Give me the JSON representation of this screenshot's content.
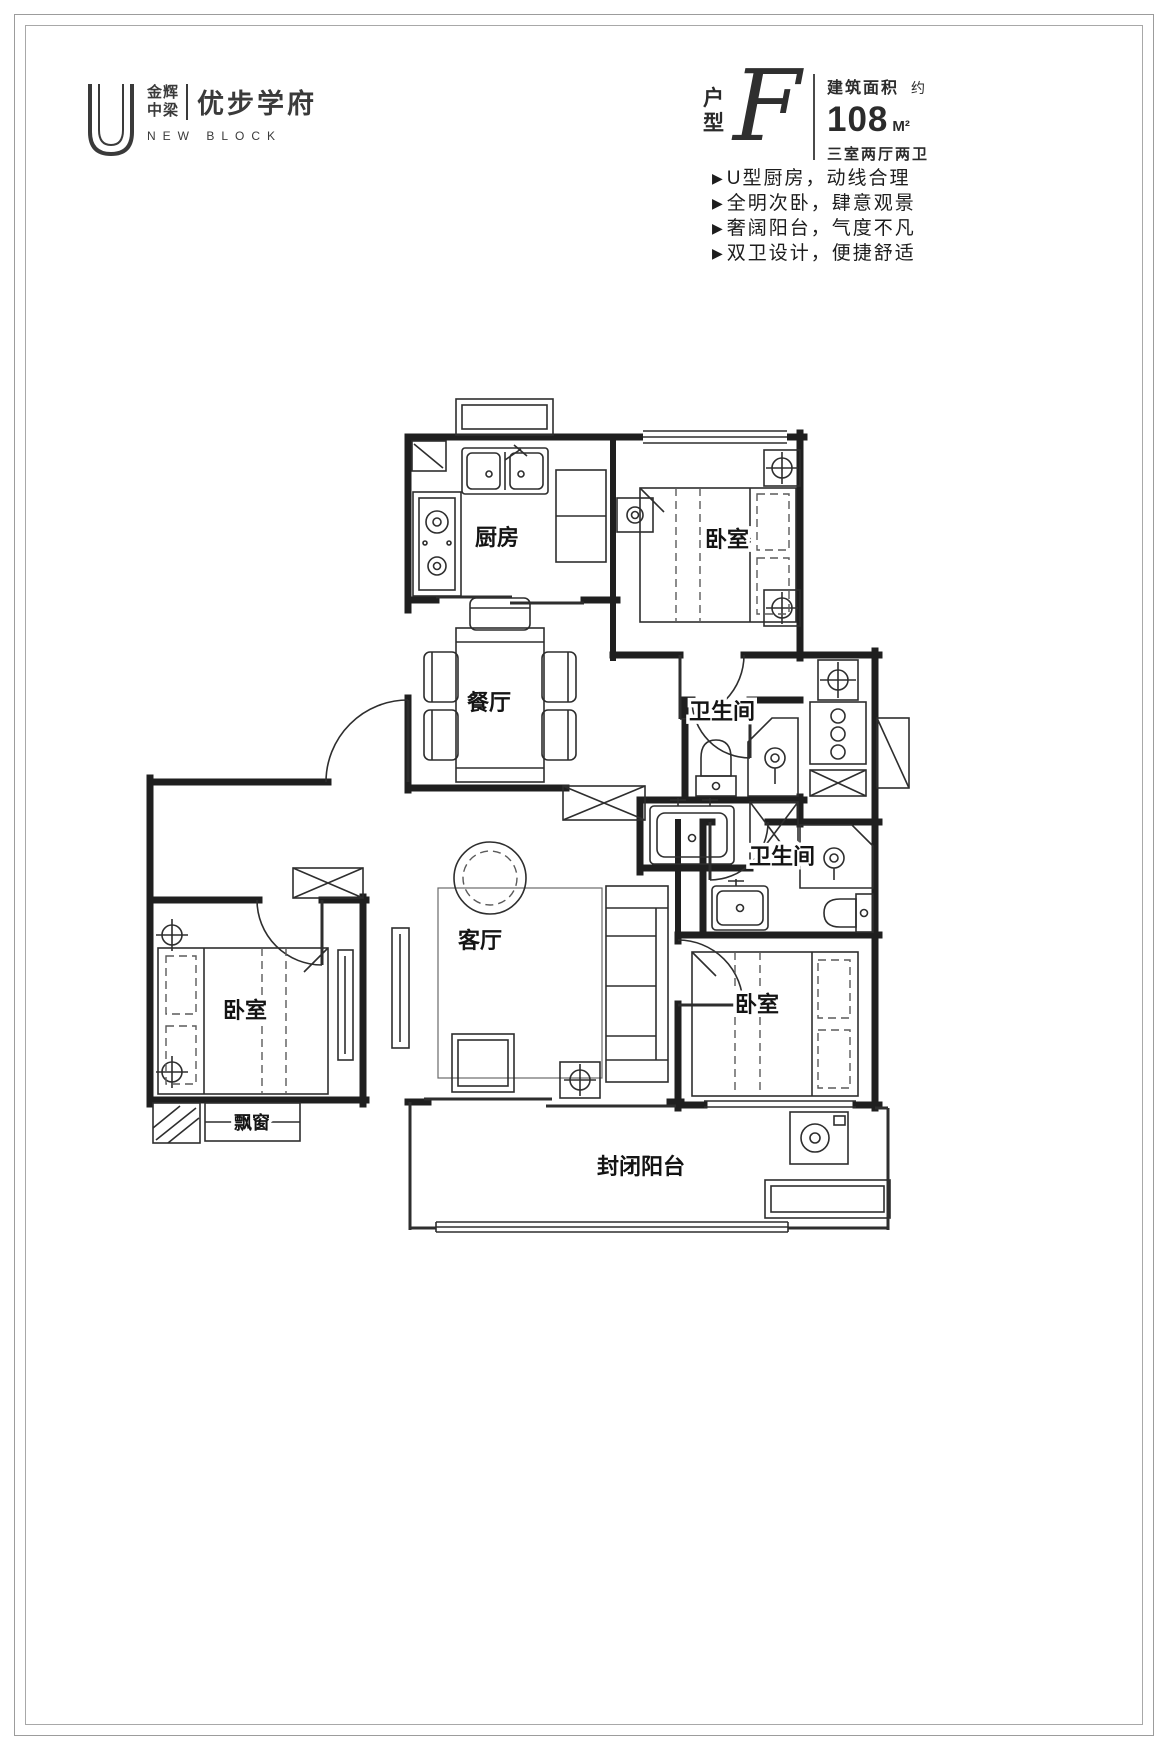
{
  "logo": {
    "brand_line1": "金辉",
    "brand_line2": "中梁",
    "name": "优步学府",
    "subtitle": "NEW BLOCK"
  },
  "header": {
    "unit_char1": "户",
    "unit_char2": "型",
    "unit_letter": "F",
    "area_label": "建筑面积",
    "area_approx": "约",
    "area_value": "108",
    "area_unit": "M²",
    "layout_desc": "三室两厅两卫"
  },
  "features_bullet": "▶",
  "features": [
    "U型厨房，动线合理",
    "全明次卧，肆意观景",
    "奢阔阳台，气度不凡",
    "双卫设计，便捷舒适"
  ],
  "floorplan": {
    "rooms": [
      {
        "id": "kitchen",
        "label": "厨房"
      },
      {
        "id": "bedroom-top",
        "label": "卧室"
      },
      {
        "id": "dining",
        "label": "餐厅"
      },
      {
        "id": "bathroom-upper",
        "label": "卫生间"
      },
      {
        "id": "bathroom-lower",
        "label": "卫生间"
      },
      {
        "id": "living",
        "label": "客厅"
      },
      {
        "id": "bedroom-left",
        "label": "卧室"
      },
      {
        "id": "bedroom-right",
        "label": "卧室"
      },
      {
        "id": "bay-window",
        "label": "飘窗"
      },
      {
        "id": "balcony",
        "label": "封闭阳台"
      }
    ]
  },
  "colors": {
    "wall": "#1f1f1f",
    "thin_line": "#2e2e2e",
    "frame": "#9c9c9c",
    "text": "#1e1e1e"
  }
}
